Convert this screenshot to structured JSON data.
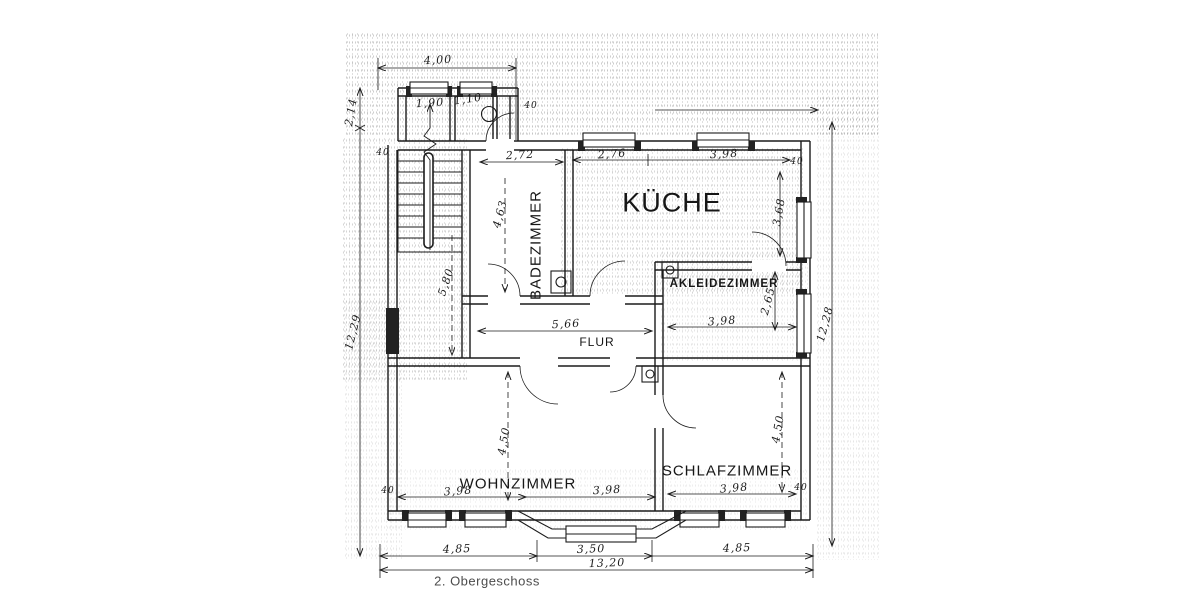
{
  "meta": {
    "caption": "2.  Obergeschoss"
  },
  "rooms": {
    "kueche": "KÜCHE",
    "badezimmer": "BADEZIMMER",
    "akleidezimmer": "AKLEIDEZIMMER",
    "flur": "FLUR",
    "wohnzimmer": "WOHNZIMMER",
    "schlafzimmer": "SCHLAFZIMMER"
  },
  "dims": {
    "annex_width": "4,00",
    "wc_left_width": "1,90",
    "wc_right_width": "1,10",
    "bad_width": "2,72",
    "kueche_seg1": "2,76",
    "kueche_width": "3,98",
    "kueche_depth": "3,68",
    "bad_depth": "4,63",
    "stairhall_depth": "5,80",
    "flur_length": "5,66",
    "akleide_width": "3,98",
    "akleide_depth": "2,65",
    "left_total": "12,29",
    "right_total": "12,28",
    "left_offset": "2,14",
    "wohn_seg1": "3,98",
    "wohn_seg2": "3,98",
    "wohn_depth": "4,50",
    "schlaf_width": "3,98",
    "schlaf_depth": "4,50",
    "bottom_left": "4,85",
    "bottom_center": "3,50",
    "bottom_right": "4,85",
    "bottom_total": "13,20",
    "wall_thickness": "40"
  },
  "colors": {
    "ink": "#1b1b1b",
    "paper": "#ffffff"
  }
}
